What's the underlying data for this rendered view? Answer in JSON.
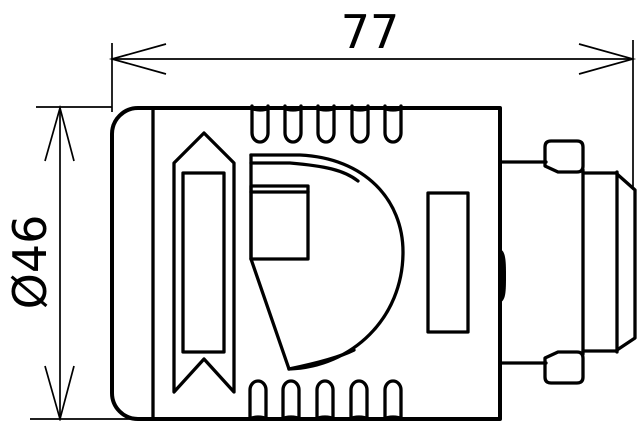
{
  "drawing": {
    "kind": "technical-dimension-drawing",
    "view": "side-view-connector",
    "background_color": "#ffffff",
    "line_color": "#000000",
    "dimensions": {
      "width": {
        "label": "77",
        "value": 77,
        "orientation": "horizontal"
      },
      "diameter": {
        "label": "Ø46",
        "value": 46,
        "orientation": "vertical"
      }
    }
  }
}
